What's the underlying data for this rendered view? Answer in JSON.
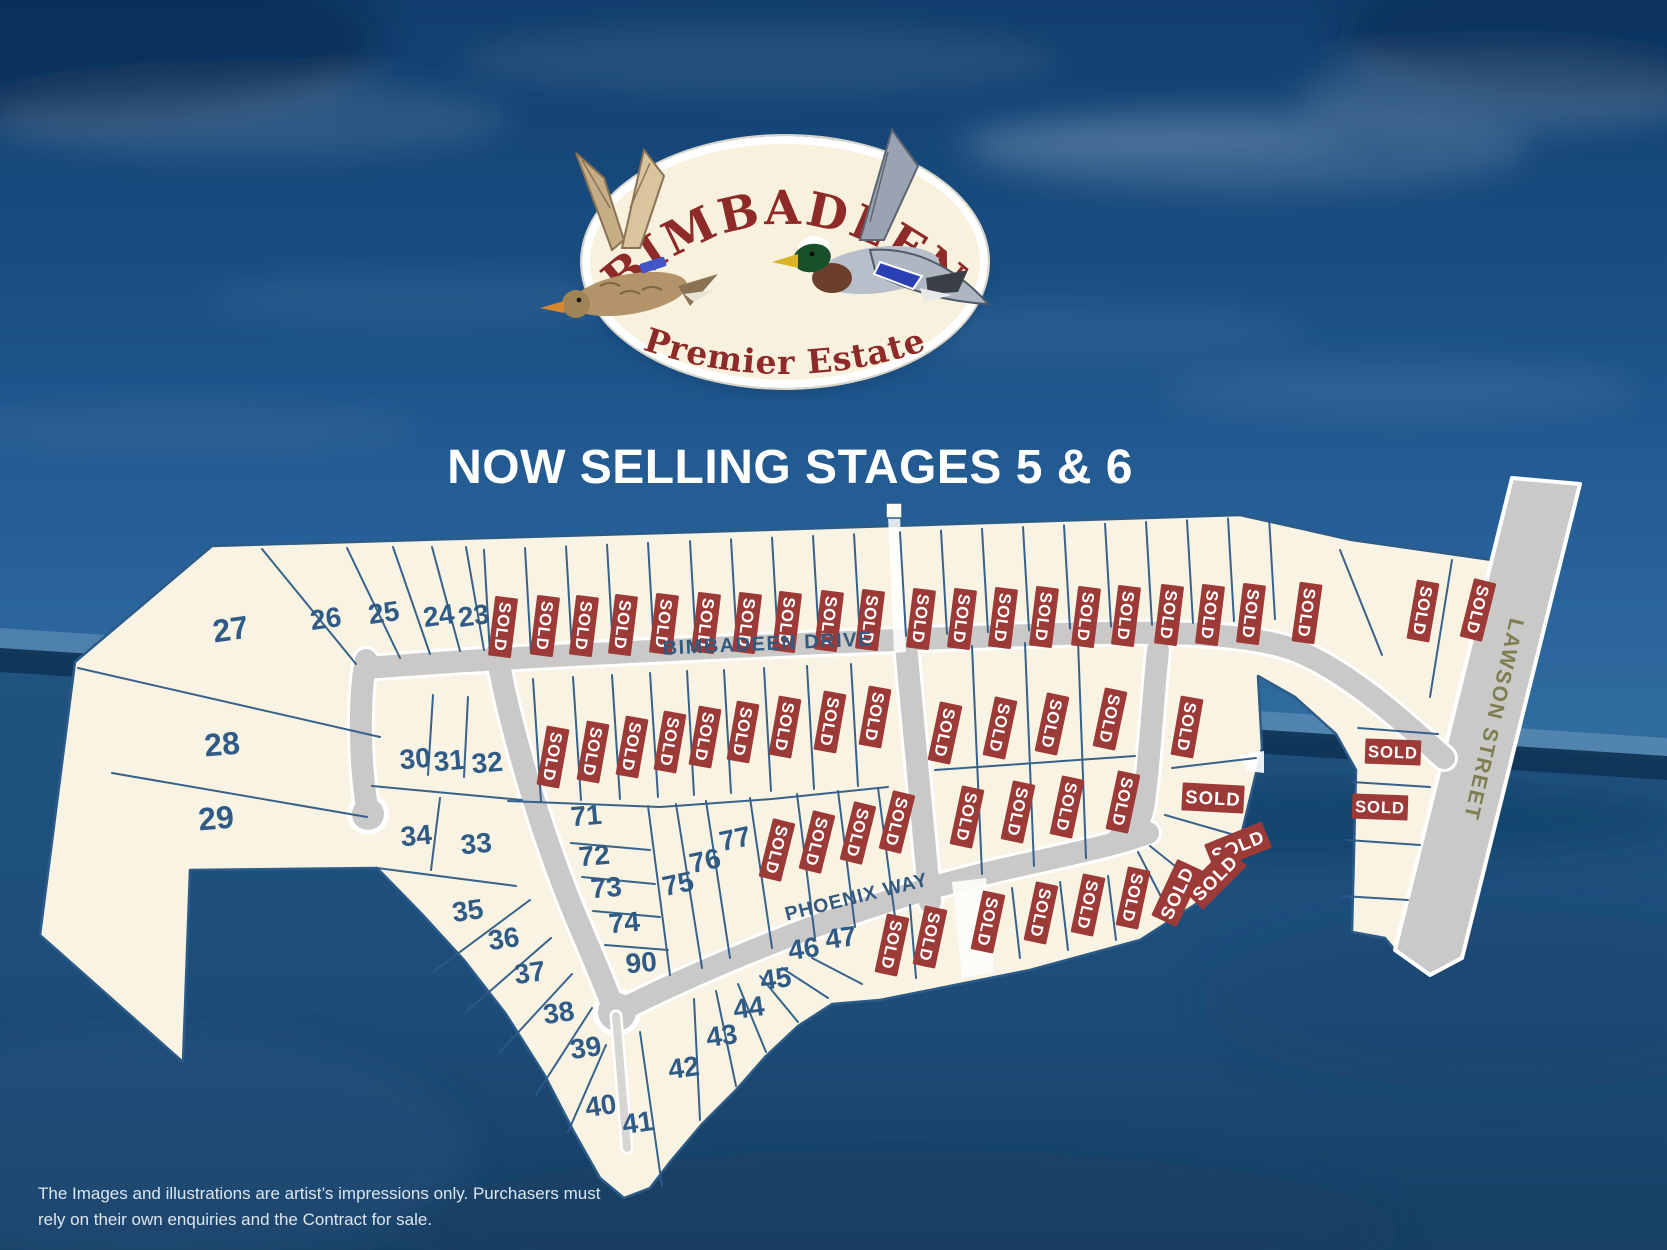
{
  "banner": {
    "title": "NOW SELLING STAGES 5 & 6"
  },
  "logo": {
    "name": "BIMBADEEN",
    "tagline": "Premier Estate"
  },
  "disclaimer": {
    "line1": "The Images and illustrations are artist’s impressions only. Purchasers must",
    "line2": "rely on their own enquiries and the Contract for sale."
  },
  "streets": {
    "bimbadeen": "BIMBADEEN DRIVE",
    "phoenix": "PHOENIX WAY",
    "lawson": "LAWSON STREET"
  },
  "map": {
    "sold_label": "SOLD",
    "numbered_lots": [
      {
        "n": "23",
        "x": 475,
        "y": 625,
        "r": -8
      },
      {
        "n": "24",
        "x": 440,
        "y": 625,
        "r": -8
      },
      {
        "n": "25",
        "x": 385,
        "y": 622,
        "r": -8
      },
      {
        "n": "26",
        "x": 327,
        "y": 628,
        "r": -8
      },
      {
        "n": "27",
        "x": 232,
        "y": 640,
        "r": -8,
        "s": 32
      },
      {
        "n": "28",
        "x": 223,
        "y": 755,
        "r": -5,
        "s": 32
      },
      {
        "n": "29",
        "x": 217,
        "y": 829,
        "r": -5,
        "s": 32
      },
      {
        "n": "30",
        "x": 416,
        "y": 768,
        "r": -5
      },
      {
        "n": "31",
        "x": 450,
        "y": 770,
        "r": -5
      },
      {
        "n": "32",
        "x": 488,
        "y": 772,
        "r": -5
      },
      {
        "n": "34",
        "x": 417,
        "y": 845,
        "r": -5
      },
      {
        "n": "33",
        "x": 477,
        "y": 853,
        "r": -5
      },
      {
        "n": "35",
        "x": 469,
        "y": 920,
        "r": -8
      },
      {
        "n": "36",
        "x": 505,
        "y": 948,
        "r": -8
      },
      {
        "n": "37",
        "x": 531,
        "y": 982,
        "r": -8
      },
      {
        "n": "38",
        "x": 560,
        "y": 1022,
        "r": -8
      },
      {
        "n": "39",
        "x": 587,
        "y": 1057,
        "r": -8
      },
      {
        "n": "40",
        "x": 602,
        "y": 1115,
        "r": -8
      },
      {
        "n": "41",
        "x": 639,
        "y": 1132,
        "r": -8
      },
      {
        "n": "42",
        "x": 685,
        "y": 1077,
        "r": -8
      },
      {
        "n": "43",
        "x": 723,
        "y": 1045,
        "r": -8
      },
      {
        "n": "44",
        "x": 750,
        "y": 1017,
        "r": -8
      },
      {
        "n": "45",
        "x": 777,
        "y": 988,
        "r": -8
      },
      {
        "n": "46",
        "x": 805,
        "y": 958,
        "r": -8
      },
      {
        "n": "47",
        "x": 842,
        "y": 947,
        "r": -8
      },
      {
        "n": "71",
        "x": 587,
        "y": 825,
        "r": -5
      },
      {
        "n": "72",
        "x": 595,
        "y": 865,
        "r": -5
      },
      {
        "n": "73",
        "x": 607,
        "y": 897,
        "r": -5
      },
      {
        "n": "74",
        "x": 625,
        "y": 932,
        "r": -5
      },
      {
        "n": "75",
        "x": 680,
        "y": 893,
        "r": -12
      },
      {
        "n": "76",
        "x": 707,
        "y": 870,
        "r": -12
      },
      {
        "n": "77",
        "x": 737,
        "y": 848,
        "r": -12
      },
      {
        "n": "90",
        "x": 642,
        "y": 972,
        "r": -5
      }
    ],
    "sold_lots": [
      {
        "x": 503,
        "y": 627,
        "v": "v",
        "r": 7
      },
      {
        "x": 545,
        "y": 626,
        "v": "v",
        "r": 7
      },
      {
        "x": 584,
        "y": 626,
        "v": "v",
        "r": 7
      },
      {
        "x": 623,
        "y": 625,
        "v": "v",
        "r": 7
      },
      {
        "x": 664,
        "y": 624,
        "v": "v",
        "r": 7
      },
      {
        "x": 706,
        "y": 623,
        "v": "v",
        "r": 7
      },
      {
        "x": 747,
        "y": 623,
        "v": "v",
        "r": 7
      },
      {
        "x": 787,
        "y": 622,
        "v": "v",
        "r": 7
      },
      {
        "x": 829,
        "y": 621,
        "v": "v",
        "r": 7
      },
      {
        "x": 870,
        "y": 620,
        "v": "v",
        "r": 7
      },
      {
        "x": 921,
        "y": 619,
        "v": "v",
        "r": 7
      },
      {
        "x": 962,
        "y": 619,
        "v": "v",
        "r": 7
      },
      {
        "x": 1003,
        "y": 618,
        "v": "v",
        "r": 7
      },
      {
        "x": 1044,
        "y": 617,
        "v": "v",
        "r": 7
      },
      {
        "x": 1086,
        "y": 617,
        "v": "v",
        "r": 7
      },
      {
        "x": 1126,
        "y": 616,
        "v": "v",
        "r": 7
      },
      {
        "x": 1169,
        "y": 615,
        "v": "v",
        "r": 7
      },
      {
        "x": 1210,
        "y": 615,
        "v": "v",
        "r": 7
      },
      {
        "x": 1251,
        "y": 614,
        "v": "v",
        "r": 7
      },
      {
        "x": 1307,
        "y": 613,
        "v": "v",
        "r": 8
      },
      {
        "x": 1423,
        "y": 611,
        "v": "v",
        "r": 10
      },
      {
        "x": 1478,
        "y": 610,
        "v": "v",
        "r": 14
      },
      {
        "x": 553,
        "y": 757,
        "v": "v",
        "r": 10
      },
      {
        "x": 593,
        "y": 752,
        "v": "v",
        "r": 10
      },
      {
        "x": 632,
        "y": 747,
        "v": "v",
        "r": 10
      },
      {
        "x": 670,
        "y": 742,
        "v": "v",
        "r": 10
      },
      {
        "x": 705,
        "y": 737,
        "v": "v",
        "r": 10
      },
      {
        "x": 743,
        "y": 732,
        "v": "v",
        "r": 10
      },
      {
        "x": 785,
        "y": 727,
        "v": "v",
        "r": 10
      },
      {
        "x": 830,
        "y": 722,
        "v": "v",
        "r": 10
      },
      {
        "x": 875,
        "y": 717,
        "v": "v",
        "r": 10
      },
      {
        "x": 945,
        "y": 733,
        "v": "v",
        "r": 12
      },
      {
        "x": 1000,
        "y": 728,
        "v": "v",
        "r": 12
      },
      {
        "x": 1052,
        "y": 724,
        "v": "v",
        "r": 12
      },
      {
        "x": 1110,
        "y": 719,
        "v": "v",
        "r": 12
      },
      {
        "x": 967,
        "y": 817,
        "v": "v",
        "r": 12
      },
      {
        "x": 1018,
        "y": 812,
        "v": "v",
        "r": 12
      },
      {
        "x": 1067,
        "y": 807,
        "v": "v",
        "r": 12
      },
      {
        "x": 1123,
        "y": 802,
        "v": "v",
        "r": 12
      },
      {
        "x": 777,
        "y": 850,
        "v": "v",
        "r": 14
      },
      {
        "x": 817,
        "y": 842,
        "v": "v",
        "r": 14
      },
      {
        "x": 858,
        "y": 833,
        "v": "v",
        "r": 14
      },
      {
        "x": 897,
        "y": 822,
        "v": "v",
        "r": 14
      },
      {
        "x": 1187,
        "y": 727,
        "v": "v",
        "r": 10
      },
      {
        "x": 1213,
        "y": 798,
        "v": "h",
        "r": 3
      },
      {
        "x": 1238,
        "y": 846,
        "v": "h",
        "r": -22
      },
      {
        "x": 1215,
        "y": 878,
        "v": "h",
        "r": -45
      },
      {
        "x": 892,
        "y": 945,
        "v": "v",
        "r": 12
      },
      {
        "x": 930,
        "y": 937,
        "v": "v",
        "r": 12
      },
      {
        "x": 988,
        "y": 922,
        "v": "v",
        "r": 12
      },
      {
        "x": 1041,
        "y": 913,
        "v": "v",
        "r": 12
      },
      {
        "x": 1088,
        "y": 905,
        "v": "v",
        "r": 12
      },
      {
        "x": 1133,
        "y": 898,
        "v": "v",
        "r": 12
      },
      {
        "x": 1177,
        "y": 893,
        "v": "h",
        "r": -65
      },
      {
        "x": 1393,
        "y": 752,
        "v": "h",
        "r": 2,
        "sc": 0.9
      },
      {
        "x": 1380,
        "y": 807,
        "v": "h",
        "r": 2,
        "sc": 0.9
      }
    ]
  },
  "colors": {
    "parcel": "#f8f3e2",
    "lot_line": "#2c5b88",
    "sold_bg": "#9c3a37",
    "sold_text": "#ffffff",
    "number": "#2f5b86",
    "road": "#cac9c7",
    "road_edge": "#ffffff",
    "street_label": "#33597f",
    "lawson_label": "#7b7f51",
    "logo_text": "#8e2b28",
    "title_text": "#ffffff",
    "disclaimer_text": "#dde6ee"
  }
}
